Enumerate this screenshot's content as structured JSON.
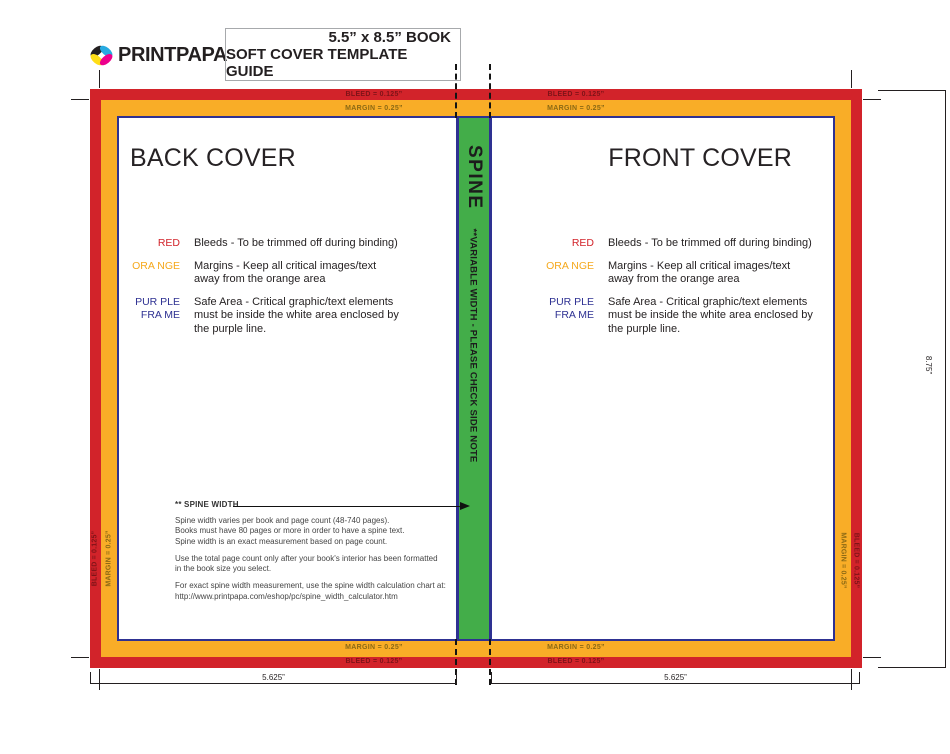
{
  "colors": {
    "red": "#D2232A",
    "orange": "#F9AD27",
    "green": "#43AD49",
    "navy": "#2E3192"
  },
  "header": {
    "logo_text": "PRINTPAPA",
    "title_line1": "5.5” x 8.5” BOOK",
    "title_line2": "SOFT COVER TEMPLATE GUIDE"
  },
  "covers": {
    "back": "BACK COVER",
    "front": "FRONT COVER"
  },
  "bands": {
    "bleed": "BLEED = 0.125”",
    "margin": "MARGIN = 0.25”"
  },
  "spine": {
    "title": "SPINE",
    "note": "**VARIABLE WIDTH - PLEASE CHECK SIDE NOTE"
  },
  "legend": {
    "rows": [
      {
        "label": "RED",
        "lines": [
          "Bleeds - To be trimmed off during binding)"
        ]
      },
      {
        "label": "ORA NGE",
        "lines": [
          "Margins - Keep all critical images/text",
          "away from the orange area"
        ]
      },
      {
        "label_line1": "PUR PLE",
        "label_line2": "FRA ME",
        "lines": [
          "Safe Area - Critical graphic/text elements",
          "must be inside the white area enclosed by",
          "the purple line."
        ]
      }
    ]
  },
  "spine_note": {
    "title": "** SPINE WIDTH",
    "paragraphs": [
      [
        "Spine width varies per book and page count (48-740 pages).",
        "Books must have 80 pages or more in order to have a spine text.",
        "Spine width is an exact measurement based on page count."
      ],
      [
        "Use the total page count only after your book's interior has been formatted",
        "in the book size you select."
      ],
      [
        "For exact spine width measurement, use the spine width calculation chart at:",
        "http://www.printpapa.com/eshop/pc/spine_width_calculator.htm"
      ]
    ]
  },
  "dimensions": {
    "cover_width": "5.625”",
    "total_height": "8.75”"
  }
}
